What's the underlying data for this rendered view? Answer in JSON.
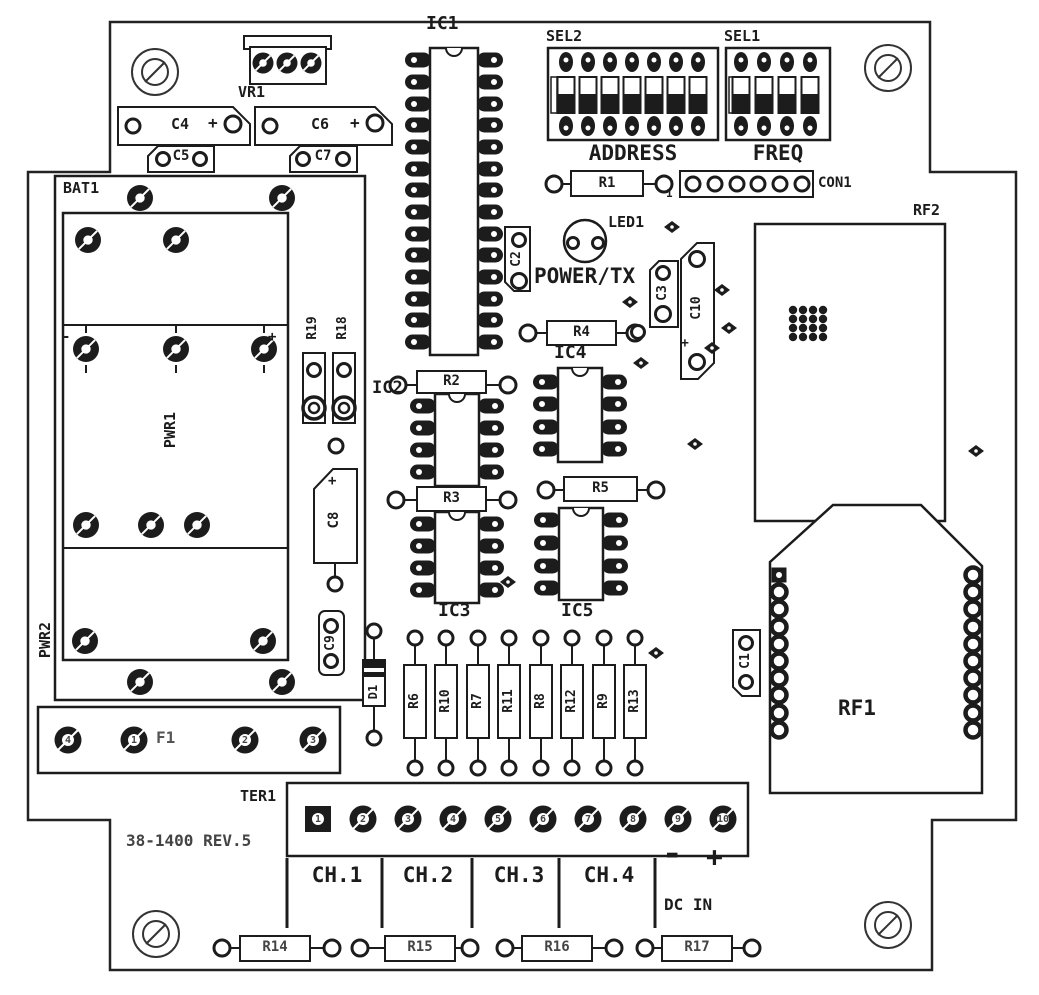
{
  "board": {
    "revision": "38-1400 REV.5"
  },
  "components": {
    "vr1": "VR1",
    "bat1": "BAT1",
    "pwr1": "PWR1",
    "pwr2": "PWR2",
    "c1": "C1",
    "c2": "C2",
    "c3": "C3",
    "c4": "C4",
    "c5": "C5",
    "c6": "C6",
    "c7": "C7",
    "c8": "C8",
    "c9": "C9",
    "c10": "C10",
    "r1": "R1",
    "r2": "R2",
    "r3": "R3",
    "r4": "R4",
    "r5": "R5",
    "r6": "R6",
    "r7": "R7",
    "r8": "R8",
    "r9": "R9",
    "r10": "R10",
    "r11": "R11",
    "r12": "R12",
    "r13": "R13",
    "r14": "R14",
    "r15": "R15",
    "r16": "R16",
    "r17": "R17",
    "r18": "R18",
    "r19": "R19",
    "ic1": "IC1",
    "ic2": "IC2",
    "ic3": "IC3",
    "ic4": "IC4",
    "ic5": "IC5",
    "d1": "D1",
    "f1": "F1",
    "led1": "LED1",
    "ter1": "TER1",
    "con1": "CON1",
    "rf1": "RF1",
    "rf2": "RF2",
    "sel1": "SEL1",
    "sel2": "SEL2"
  },
  "texts": {
    "address": "ADDRESS",
    "freq": "FREQ",
    "power_tx": "POWER/TX",
    "plus": "+",
    "dc_minus": "-",
    "dc_plus": "+",
    "dc_in": "DC IN",
    "con1_pin1": "1",
    "pwr_minus": "-",
    "pwr_plus": "+"
  },
  "channels": [
    "CH.1",
    "CH.2",
    "CH.3",
    "CH.4"
  ],
  "terminal_numbers": [
    "1",
    "2",
    "3",
    "4",
    "5",
    "6",
    "7",
    "8",
    "9",
    "10"
  ],
  "fuse_pad_numbers": [
    "4",
    "1",
    "2",
    "3"
  ],
  "dip_switches": [
    {
      "id": "sel2",
      "label": "SEL2",
      "caption": "ADDRESS",
      "positions": 7
    },
    {
      "id": "sel1",
      "label": "SEL1",
      "caption": "FREQ",
      "positions": 4
    }
  ]
}
